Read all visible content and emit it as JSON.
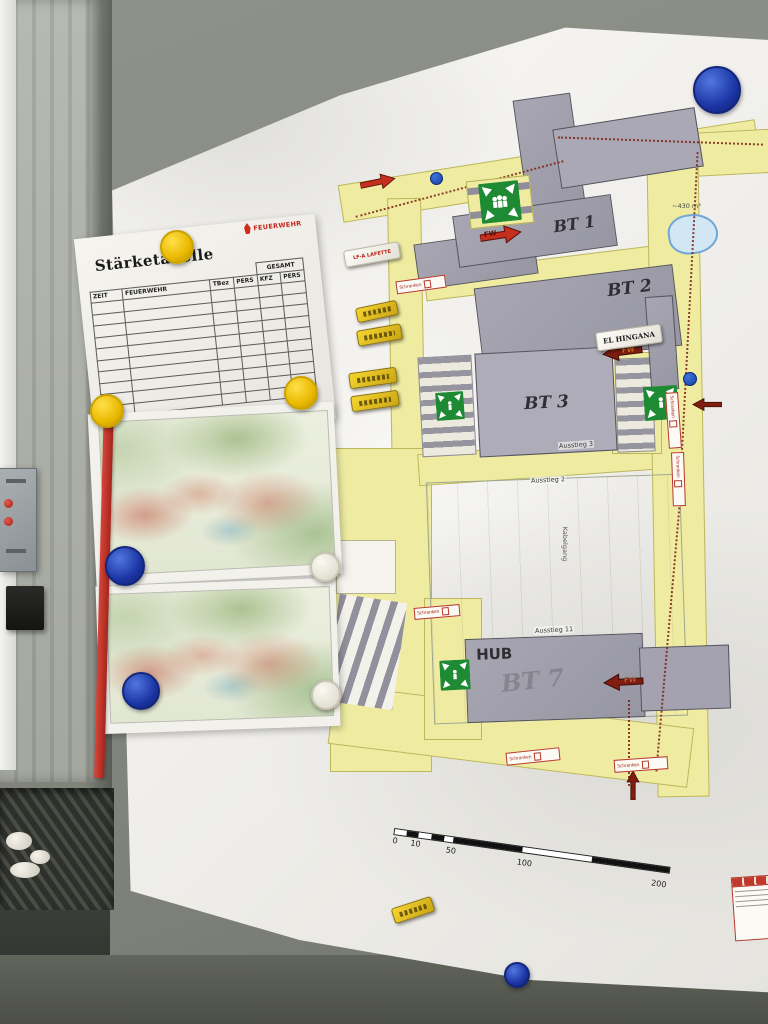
{
  "staerketabelle": {
    "title": "Stärketabelle",
    "logo": "FEUERWEHR",
    "gesamt": "GESAMT",
    "columns": [
      "ZEIT",
      "FEUERWEHR",
      "TBez",
      "PERS",
      "KFZ",
      "PERS"
    ],
    "rows": 10
  },
  "plan": {
    "buildings": {
      "bt1": "BT 1",
      "bt2": "BT 2",
      "bt3": "BT 3",
      "hub": "HUB",
      "bt7_handwritten": "BT 7"
    },
    "exits": {
      "a2": "Ausstieg 2",
      "a3": "Ausstieg 3",
      "a11": "Ausstieg 11"
    },
    "corridor": "Kabelgang",
    "pond_label": "~430 m³",
    "gate_label": "Schranken",
    "fw": "FW",
    "scale_ticks": [
      "0",
      "10",
      "50",
      "100",
      "200"
    ]
  },
  "magnet_labels": {
    "lafette": "LF-A LAFETTE",
    "hingana": "EL HINGANA"
  },
  "colors": {
    "road": "#efeca2",
    "building": "#9d9ca8",
    "route_dotted": "#7c2010",
    "assembly_green": "#1f8a34",
    "arrow_bright": "#c62f1d",
    "arrow_dark": "#7e1d10",
    "magnet_blue": "#1b35a5",
    "magnet_yellow": "#e9b800"
  }
}
